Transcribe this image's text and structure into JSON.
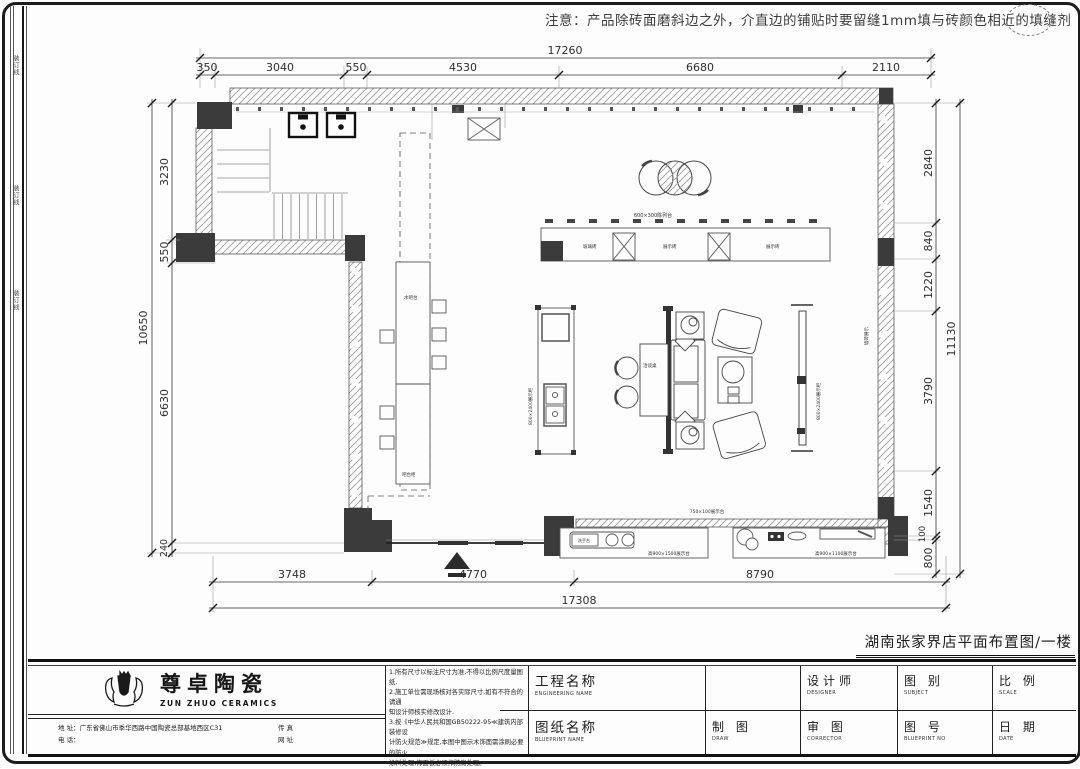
{
  "note_top": "注意：产品除砖面磨斜边之外，介直边的铺贴时要留缝1mm填与砖颜色相近的填缝剂",
  "drawing_title": "湖南张家界店平面布置图/一楼",
  "margin_marks": [
    "装订线",
    "装订线",
    "装订线"
  ],
  "dims": {
    "top": {
      "overall": "17260",
      "s": [
        "350",
        "3040",
        "550",
        "4530",
        "6680",
        "2110"
      ]
    },
    "left": {
      "overall": "10650",
      "s": [
        "3230",
        "550",
        "6630",
        "240"
      ]
    },
    "right": {
      "overall": "11130",
      "s": [
        "2840",
        "840",
        "1220",
        "3790",
        "1540",
        "100",
        "800"
      ]
    },
    "bottom": {
      "overall": "17308",
      "s": [
        "3748",
        "4770",
        "8790"
      ]
    }
  },
  "plan": {
    "labels": {
      "counter_caption": "600×300陈列台",
      "sec1": "玻璃砖",
      "sec2": "展示砖",
      "sec3": "展示砖",
      "bar": "水吧台",
      "bar2": "吧台柜",
      "tall": "800×2400展示柜",
      "panel": "800×2400展示柜",
      "wall": "墙砖展示",
      "desk": "洽谈桌",
      "strip": "750×100展示台",
      "sinkbox": "洗手台",
      "blcap": "高900×1500展示台",
      "brcap": "高900×1100展示台"
    }
  },
  "title_block": {
    "logo_cn": "尊卓陶瓷",
    "logo_en": "ZUN ZHUO CERAMICS",
    "address": "地 址：广东省佛山市季华西路中国陶瓷总部基地西区C31",
    "phone": "电 话：",
    "fax": "传 真",
    "web": "网 址",
    "notes": [
      "1.所有尺寸以标注尺寸为准,不得以比例尺度量图纸,",
      "2.施工单位需现场核对各实际尺寸,如有不符合的请通",
      "知设计师核实修改设计.",
      "3.按《中华人民共和国GB50222-95≪建筑内部装修设",
      "计防火规范≫规定,本图中图示木饰面需涂刷必要的防火",
      "涂料处理,饰面板必须作防腐处理。"
    ],
    "f_project": {
      "cn": "工程名称",
      "en": "ENGINEERING NAME"
    },
    "f_sheet": {
      "cn": "图纸名称",
      "en": "BLUEPRINT NAME"
    },
    "f_designer": {
      "cn": "设计师",
      "en": "DESIGNER"
    },
    "f_subject": {
      "cn": "图 别",
      "en": "SUBJECT"
    },
    "f_scale": {
      "cn": "比 例",
      "en": "SCALE"
    },
    "f_draw": {
      "cn": "制 图",
      "en": "DRAW"
    },
    "f_corrector": {
      "cn": "审 图",
      "en": "CORRECTOR"
    },
    "f_no": {
      "cn": "图 号",
      "en": "BLUEPRINT NO"
    },
    "f_date": {
      "cn": "日 期",
      "en": "DATE"
    }
  }
}
